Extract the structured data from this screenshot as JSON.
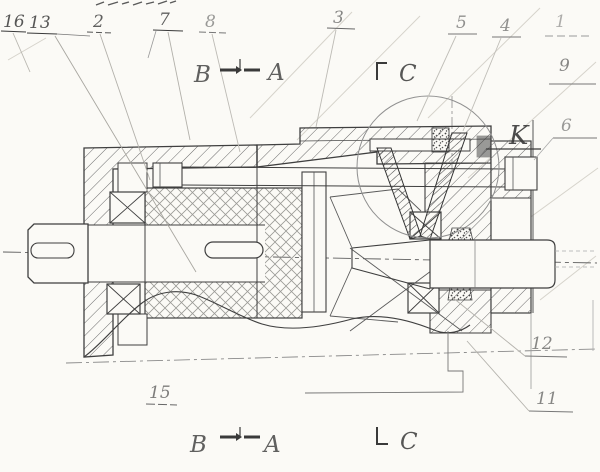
{
  "document": {
    "kind": "scanned hand-drawn sectional assembly drawing",
    "subject": "geared coupling / reducer cross-section"
  },
  "callouts": {
    "n16": "16",
    "n13": "13",
    "n2": "2",
    "n7": "7",
    "n8": "8",
    "n3": "3",
    "n5": "5",
    "n4": "4",
    "n1": "1",
    "n9": "9",
    "n6": "6",
    "n12": "12",
    "n11": "11",
    "n15": "15"
  },
  "markers": {
    "section_b": "B",
    "section_a": "A",
    "view_c": "C",
    "view_k": "K"
  },
  "colors": {
    "ink": "#3a3a3a",
    "faint_line": "#999999",
    "paper": "#fbfaf6"
  }
}
